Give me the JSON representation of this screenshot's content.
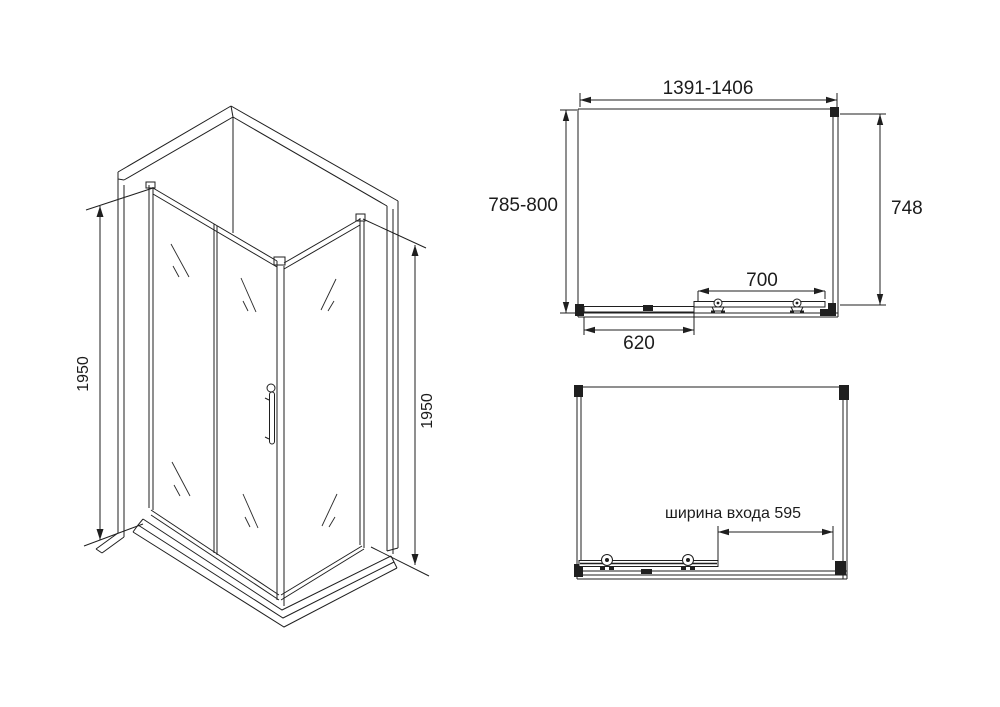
{
  "views": {
    "isometric": {
      "height_left": "1950",
      "height_right": "1950"
    },
    "plan": {
      "width": "1391-1406",
      "depth": "785-800",
      "side_depth": "748",
      "door_width": "700",
      "fixed_panel": "620"
    },
    "front": {
      "entrance": "ширина входа 595"
    },
    "colors": {
      "line": "#1f1f1f",
      "background": "#ffffff"
    }
  }
}
